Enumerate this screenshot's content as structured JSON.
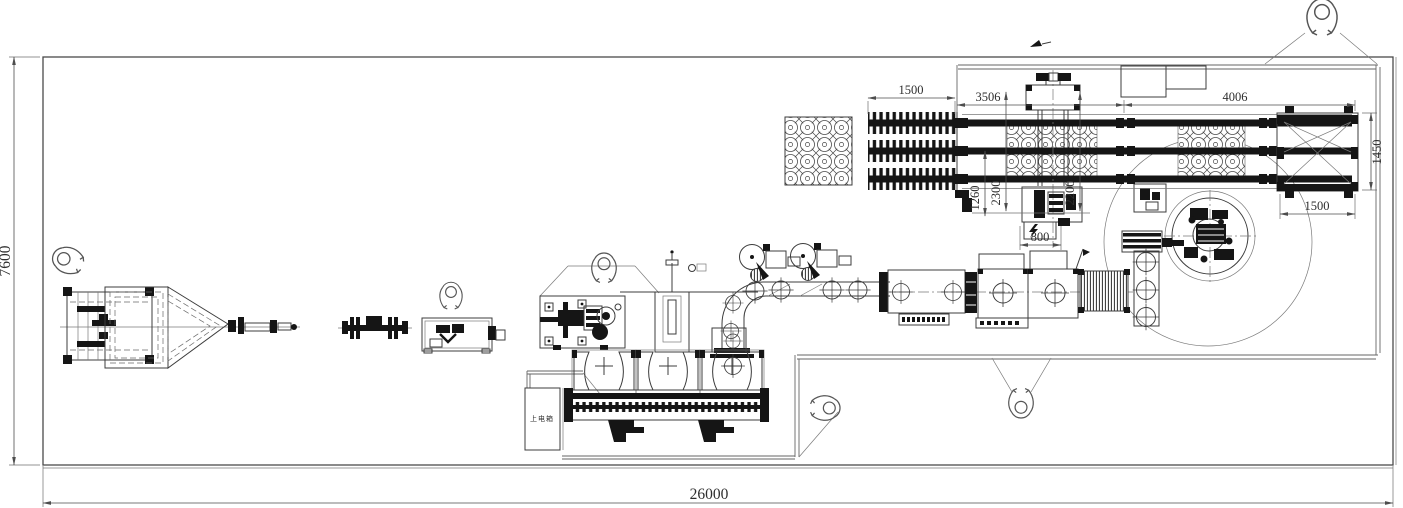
{
  "drawing": {
    "kind": "factory-equipment-layout-plan",
    "overall": {
      "width_mm": "26000",
      "height_mm": "7600"
    },
    "conveyor_dims": {
      "left_section": "1500",
      "mid_section": "3506",
      "right_section": "4006",
      "offset_1260": "1260",
      "gantry_left_height": "2300",
      "gantry_right_height": "2200",
      "gantry_width": "800",
      "lift_table_depth": "1450",
      "lift_table_width": "1500"
    },
    "labels": {
      "power_box": "上电箱"
    },
    "colors": {
      "background": "#ffffff",
      "line": "#3c3c3c",
      "dark_fill": "#151515",
      "dim_line": "#4d4d4d"
    },
    "person_marker_count": 6
  }
}
